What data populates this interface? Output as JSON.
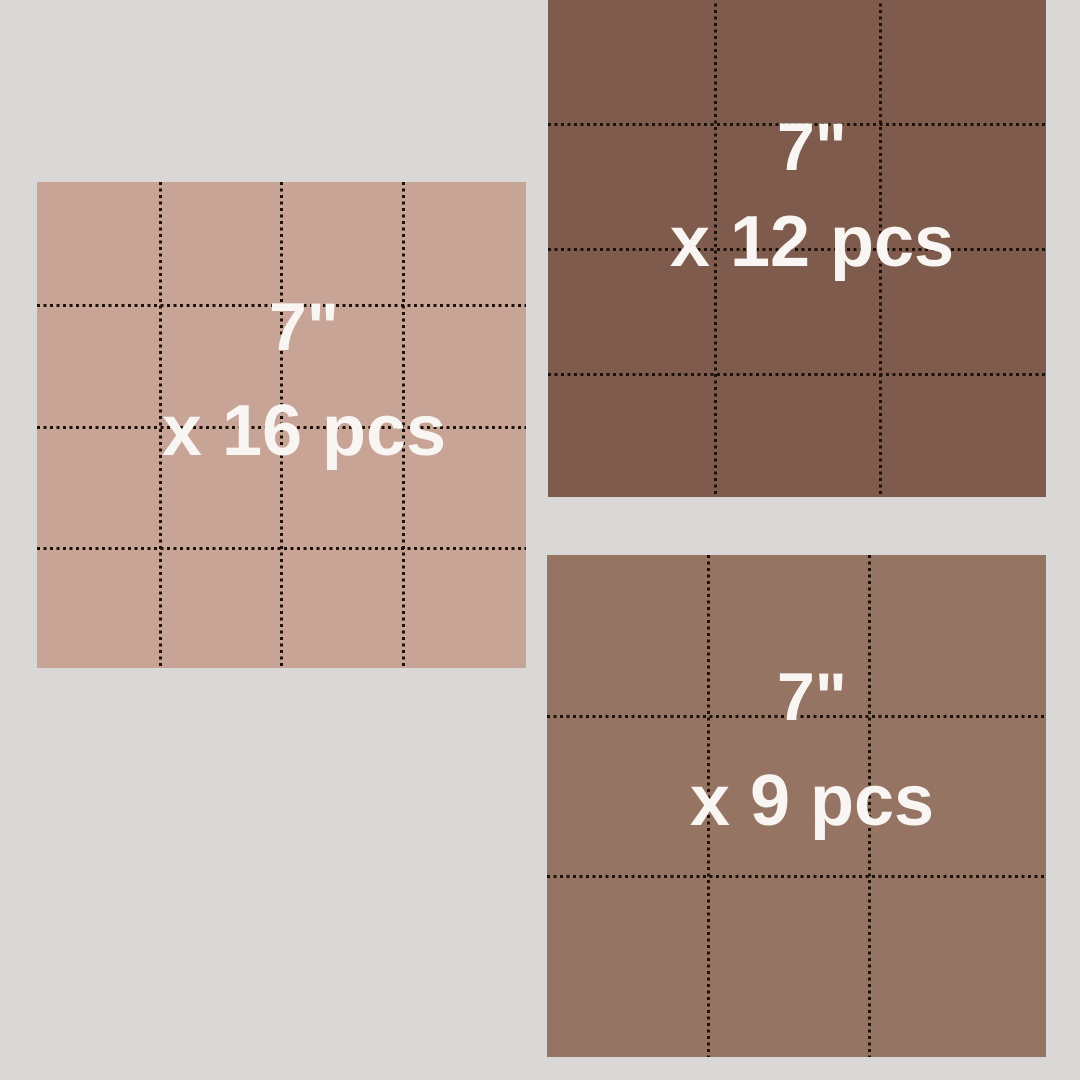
{
  "canvas": {
    "width": 1080,
    "height": 1080,
    "background_color": "#d9d8d6"
  },
  "style": {
    "text_color": "#f8f5f2",
    "cut_line_color": "#1c1209"
  },
  "squares": [
    {
      "id": "16pcs",
      "piece_size_label": "7\"",
      "piece_count_label": "x 16 pcs",
      "pieces": 16,
      "grid_cols": 4,
      "grid_rows": 4,
      "fabric_color": "#c7a496",
      "x": 37,
      "y": 182,
      "width": 489,
      "height": 486,
      "v_lines": [
        122,
        243,
        365
      ],
      "h_lines": [
        122,
        244,
        365
      ],
      "label_x": 304,
      "size_label_y": 327,
      "count_label_y": 431
    },
    {
      "id": "12pcs",
      "piece_size_label": "7\"",
      "piece_count_label": "x 12 pcs",
      "pieces": 12,
      "grid_cols": 3,
      "grid_rows": 4,
      "fabric_color": "#7e5b4c",
      "x": 548,
      "y": -3,
      "width": 498,
      "height": 500,
      "v_lines": [
        166,
        331
      ],
      "h_lines": [
        126,
        251,
        376
      ],
      "label_x": 812,
      "size_label_y": 147,
      "count_label_y": 242
    },
    {
      "id": "9pcs",
      "piece_size_label": "7\"",
      "piece_count_label": "x 9 pcs",
      "pieces": 9,
      "grid_cols": 3,
      "grid_rows": 3,
      "fabric_color": "#957463",
      "x": 547,
      "y": 555,
      "width": 499,
      "height": 502,
      "v_lines": [
        160,
        321
      ],
      "h_lines": [
        160,
        320
      ],
      "label_x": 812,
      "size_label_y": 697,
      "count_label_y": 801
    }
  ]
}
